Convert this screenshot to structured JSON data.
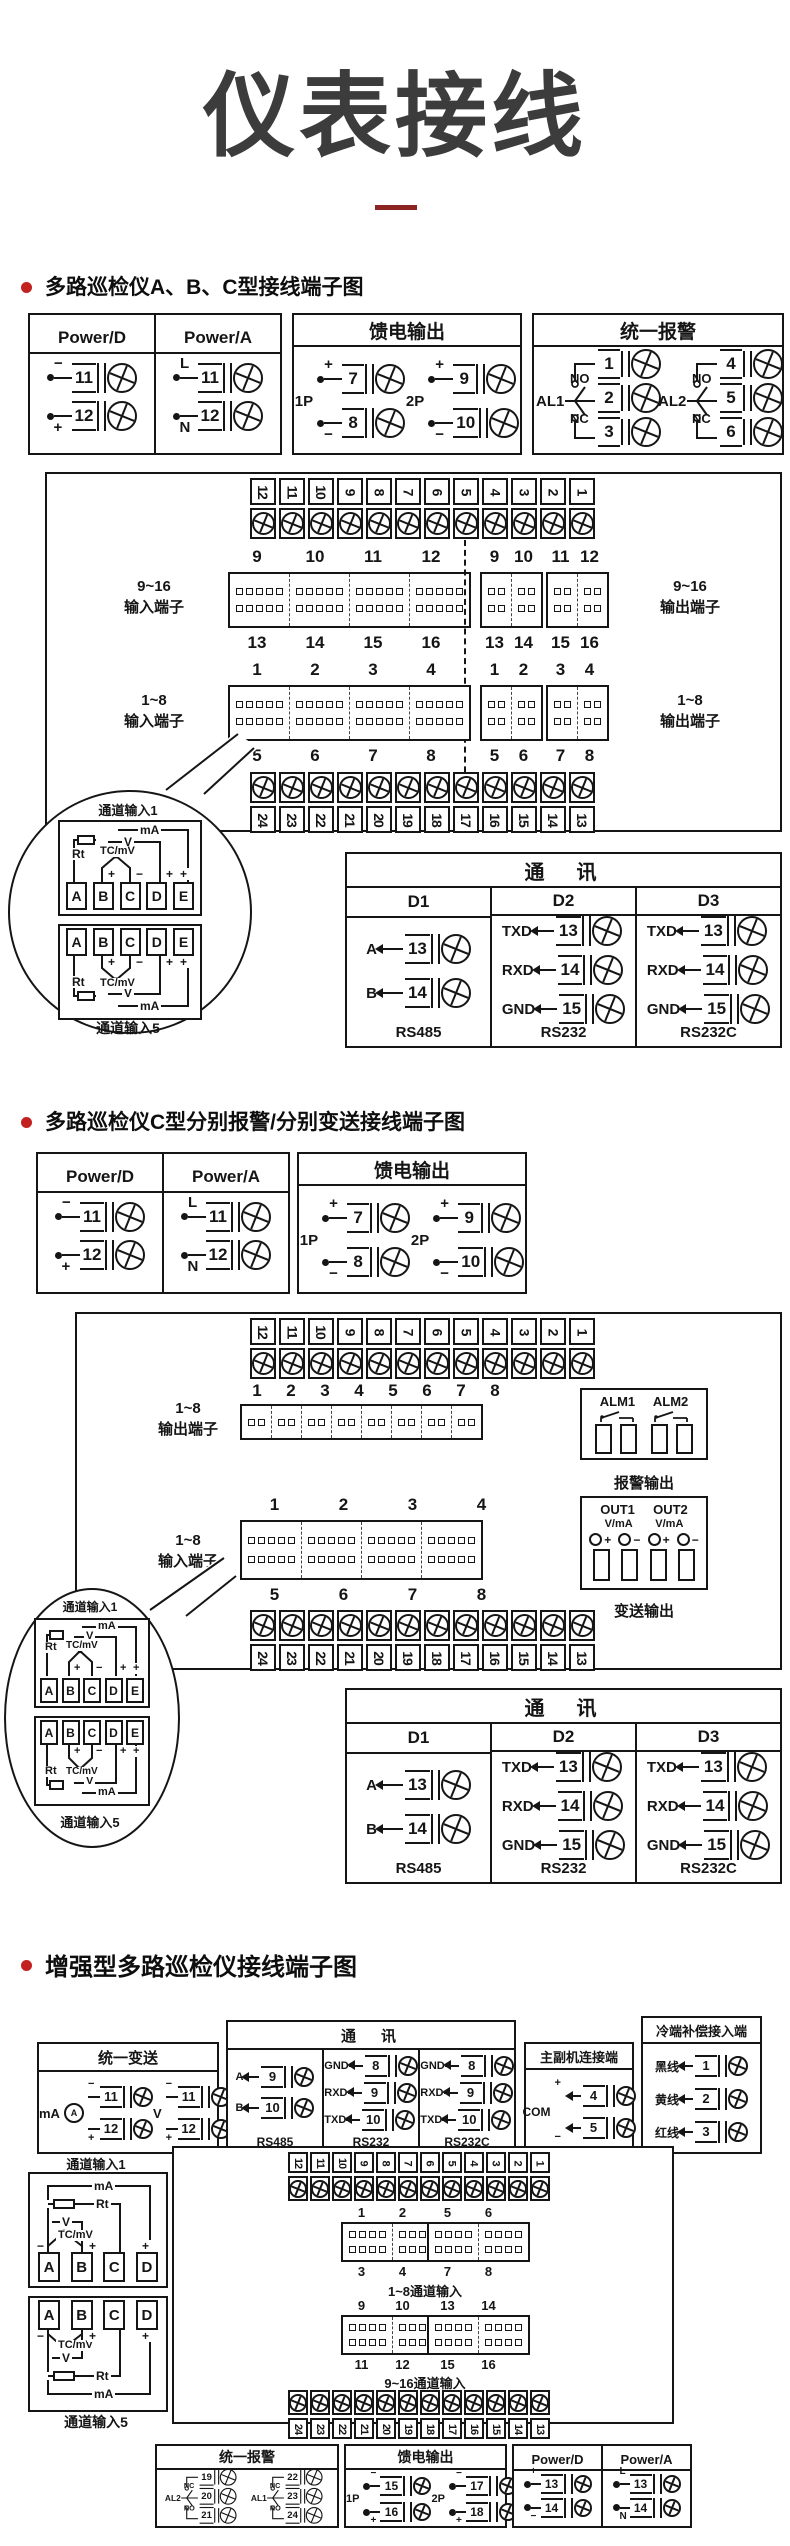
{
  "page": {
    "title": "仪表接线"
  },
  "chan": {
    "in1": "通道输入1",
    "in5": "通道输入5",
    "ma": "mA",
    "v": "V",
    "rt": "Rt",
    "tc": "TC/mV",
    "plus": "+",
    "minus": "−",
    "letters5": [
      "A",
      "B",
      "C",
      "D",
      "E"
    ],
    "letters4": [
      "A",
      "B",
      "C",
      "D"
    ]
  },
  "s1": {
    "heading": "多路巡检仪A、B、C型接线端子图",
    "power": {
      "col_d": "Power/D",
      "col_a": "Power/A",
      "d": [
        {
          "sign": "−",
          "num": "11"
        },
        {
          "sign": "+",
          "num": "12"
        }
      ],
      "a": [
        {
          "sign": "L",
          "num": "11"
        },
        {
          "sign": "N",
          "num": "12"
        }
      ]
    },
    "feed": {
      "title": "馈电输出",
      "groups": [
        {
          "name": "1P",
          "terms": [
            {
              "sign": "+",
              "num": "7"
            },
            {
              "sign": "−",
              "num": "8"
            }
          ]
        },
        {
          "name": "2P",
          "terms": [
            {
              "sign": "+",
              "num": "9"
            },
            {
              "sign": "−",
              "num": "10"
            }
          ]
        }
      ]
    },
    "alarm": {
      "title": "统一报警",
      "groups": [
        {
          "name": "AL1",
          "tap1": "NO",
          "tap2": "NC",
          "nums": [
            "1",
            "2",
            "3"
          ]
        },
        {
          "name": "AL2",
          "tap1": "NO",
          "tap2": "NC",
          "nums": [
            "4",
            "5",
            "6"
          ]
        }
      ]
    },
    "strip_top": [
      "12",
      "11",
      "10",
      "9",
      "8",
      "7",
      "6",
      "5",
      "4",
      "3",
      "2",
      "1"
    ],
    "strip_bottom": [
      "24",
      "23",
      "22",
      "21",
      "20",
      "19",
      "18",
      "17",
      "16",
      "15",
      "14",
      "13"
    ],
    "in916": {
      "line1": "9~16",
      "line2": "输入端子",
      "top": [
        "9",
        "10",
        "11",
        "12"
      ],
      "bottom": [
        "13",
        "14",
        "15",
        "16"
      ]
    },
    "in18": {
      "line1": "1~8",
      "line2": "输入端子",
      "top": [
        "1",
        "2",
        "3",
        "4"
      ],
      "bottom": [
        "5",
        "6",
        "7",
        "8"
      ]
    },
    "out916": {
      "line1": "9~16",
      "line2": "输出端子",
      "top_a": [
        "9",
        "10"
      ],
      "top_b": [
        "11",
        "12"
      ],
      "bot_a": [
        "13",
        "14"
      ],
      "bot_b": [
        "15",
        "16"
      ]
    },
    "out18": {
      "line1": "1~8",
      "line2": "输出端子",
      "top_a": [
        "1",
        "2"
      ],
      "top_b": [
        "3",
        "4"
      ],
      "bot_a": [
        "5",
        "6"
      ],
      "bot_b": [
        "7",
        "8"
      ]
    },
    "comm": {
      "title": "通　讯",
      "cols": [
        {
          "head": "D1",
          "rows": [
            {
              "label": "A",
              "num": "13"
            },
            {
              "label": "B",
              "num": "14"
            }
          ],
          "foot": "RS485"
        },
        {
          "head": "D2",
          "rows": [
            {
              "label": "TXD",
              "num": "13"
            },
            {
              "label": "RXD",
              "num": "14"
            },
            {
              "label": "GND",
              "num": "15"
            }
          ],
          "foot": "RS232"
        },
        {
          "head": "D3",
          "rows": [
            {
              "label": "TXD",
              "num": "13"
            },
            {
              "label": "RXD",
              "num": "14"
            },
            {
              "label": "GND",
              "num": "15"
            }
          ],
          "foot": "RS232C"
        }
      ]
    }
  },
  "s2": {
    "heading": "多路巡检仪C型分别报警/分别变送接线端子图",
    "power": {
      "col_d": "Power/D",
      "col_a": "Power/A",
      "d": [
        {
          "sign": "−",
          "num": "11"
        },
        {
          "sign": "+",
          "num": "12"
        }
      ],
      "a": [
        {
          "sign": "L",
          "num": "11"
        },
        {
          "sign": "N",
          "num": "12"
        }
      ]
    },
    "feed": {
      "title": "馈电输出",
      "groups": [
        {
          "name": "1P",
          "terms": [
            {
              "sign": "+",
              "num": "7"
            },
            {
              "sign": "−",
              "num": "8"
            }
          ]
        },
        {
          "name": "2P",
          "terms": [
            {
              "sign": "+",
              "num": "9"
            },
            {
              "sign": "−",
              "num": "10"
            }
          ]
        }
      ]
    },
    "strip_top": [
      "12",
      "11",
      "10",
      "9",
      "8",
      "7",
      "6",
      "5",
      "4",
      "3",
      "2",
      "1"
    ],
    "strip_bottom": [
      "24",
      "23",
      "22",
      "21",
      "20",
      "19",
      "18",
      "17",
      "16",
      "15",
      "14",
      "13"
    ],
    "out18": {
      "line1": "1~8",
      "line2": "输出端子",
      "labels": [
        "1",
        "2",
        "3",
        "4",
        "5",
        "6",
        "7",
        "8"
      ]
    },
    "alm": {
      "labels": [
        "ALM1",
        "ALM2"
      ],
      "caption": "报警输出"
    },
    "in18": {
      "line1": "1~8",
      "line2": "输入端子",
      "top": [
        "1",
        "2",
        "3",
        "4"
      ],
      "bottom": [
        "5",
        "6",
        "7",
        "8"
      ]
    },
    "out": {
      "labels": [
        "OUT1",
        "OUT2"
      ],
      "sub": "V/mA",
      "plus": "+",
      "minus": "−",
      "caption": "变送输出"
    },
    "comm": {
      "title": "通　讯",
      "cols": [
        {
          "head": "D1",
          "rows": [
            {
              "label": "A",
              "num": "13"
            },
            {
              "label": "B",
              "num": "14"
            }
          ],
          "foot": "RS485"
        },
        {
          "head": "D2",
          "rows": [
            {
              "label": "TXD",
              "num": "13"
            },
            {
              "label": "RXD",
              "num": "14"
            },
            {
              "label": "GND",
              "num": "15"
            }
          ],
          "foot": "RS232"
        },
        {
          "head": "D3",
          "rows": [
            {
              "label": "TXD",
              "num": "13"
            },
            {
              "label": "RXD",
              "num": "14"
            },
            {
              "label": "GND",
              "num": "15"
            }
          ],
          "foot": "RS232C"
        }
      ]
    }
  },
  "s3": {
    "heading": "增强型多路巡检仪接线端子图",
    "transmit": {
      "title": "统一变送",
      "meter": "A",
      "groups": [
        {
          "name": "mA",
          "terms": [
            {
              "sign": "−",
              "num": "11"
            },
            {
              "sign": "+",
              "num": "12"
            }
          ]
        },
        {
          "name": "V",
          "terms": [
            {
              "sign": "−",
              "num": "11"
            },
            {
              "sign": "+",
              "num": "12"
            }
          ]
        }
      ]
    },
    "comm": {
      "title": "通　讯",
      "cols": [
        {
          "rows": [
            {
              "label": "A",
              "num": "9"
            },
            {
              "label": "B",
              "num": "10"
            }
          ],
          "foot": "RS485"
        },
        {
          "rows": [
            {
              "label": "GND",
              "num": "8"
            },
            {
              "label": "RXD",
              "num": "9"
            },
            {
              "label": "TXD",
              "num": "10"
            }
          ],
          "foot": "RS232"
        },
        {
          "rows": [
            {
              "label": "GND",
              "num": "8"
            },
            {
              "label": "RXD",
              "num": "9"
            },
            {
              "label": "TXD",
              "num": "10"
            }
          ],
          "foot": "RS232C"
        }
      ]
    },
    "link": {
      "title": "主副机连接端",
      "com": "COM",
      "terms": [
        {
          "sign": "+",
          "num": "4"
        },
        {
          "sign": "−",
          "num": "5"
        }
      ]
    },
    "cold": {
      "title": "冷端补偿接入端",
      "rows": [
        {
          "label": "黑线",
          "num": "1"
        },
        {
          "label": "黄线",
          "num": "2"
        },
        {
          "label": "红线",
          "num": "3"
        }
      ]
    },
    "strip_top": [
      "12",
      "11",
      "10",
      "9",
      "8",
      "7",
      "6",
      "5",
      "4",
      "3",
      "2",
      "1"
    ],
    "strip_bottom": [
      "24",
      "23",
      "22",
      "21",
      "20",
      "19",
      "18",
      "17",
      "16",
      "15",
      "14",
      "13"
    ],
    "ch18": {
      "caption": "1~8通道输入",
      "blocks": [
        {
          "top": [
            "1",
            "2"
          ],
          "bottom": [
            "3",
            "4"
          ]
        },
        {
          "top": [
            "5",
            "6"
          ],
          "bottom": [
            "7",
            "8"
          ]
        }
      ]
    },
    "ch916": {
      "caption": "9~16通道输入",
      "blocks": [
        {
          "top": [
            "9",
            "10"
          ],
          "bottom": [
            "11",
            "12"
          ]
        },
        {
          "top": [
            "13",
            "14"
          ],
          "bottom": [
            "15",
            "16"
          ]
        }
      ]
    },
    "chin1": "通道输入1",
    "chin5": "通道输入5",
    "alarm": {
      "title": "统一报警",
      "groups": [
        {
          "name": "AL2",
          "tap1": "NC",
          "tap2": "NO",
          "nums": [
            "19",
            "20",
            "21"
          ]
        },
        {
          "name": "AL1",
          "tap1": "NC",
          "tap2": "NO",
          "nums": [
            "22",
            "23",
            "24"
          ]
        }
      ]
    },
    "feed": {
      "title": "馈电输出",
      "groups": [
        {
          "name": "1P",
          "terms": [
            {
              "sign": "−",
              "num": "15"
            },
            {
              "sign": "+",
              "num": "16"
            }
          ]
        },
        {
          "name": "2P",
          "terms": [
            {
              "sign": "−",
              "num": "17"
            },
            {
              "sign": "+",
              "num": "18"
            }
          ]
        }
      ]
    },
    "power": {
      "col_d": "Power/D",
      "col_a": "Power/A",
      "d": [
        {
          "sign": "+",
          "num": "13"
        },
        {
          "sign": "−",
          "num": "14"
        }
      ],
      "a": [
        {
          "sign": "L",
          "num": "13"
        },
        {
          "sign": "N",
          "num": "14"
        }
      ]
    }
  },
  "colors": {
    "accent_red": "#c2211f",
    "dash_red": "#8d2424",
    "line": "#151515",
    "title_gray": "#3c3c3c"
  }
}
